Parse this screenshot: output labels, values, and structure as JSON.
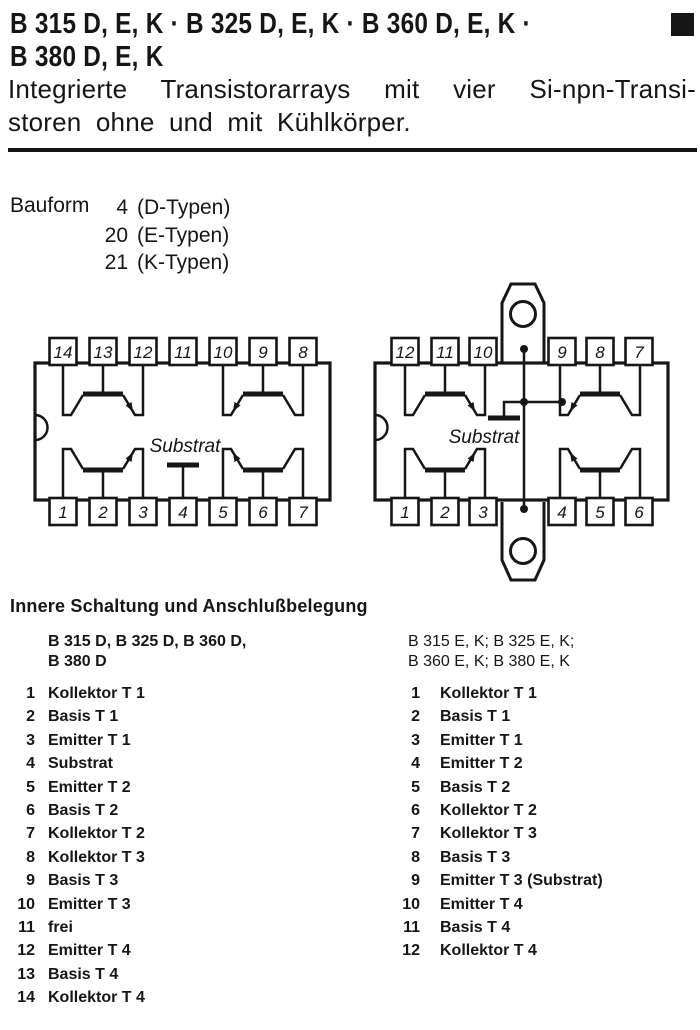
{
  "colors": {
    "ink": "#161616",
    "paper": "#ffffff"
  },
  "page": {
    "title_line1": "B 315 D, E, K · B 325 D, E, K · B 360 D, E, K ·",
    "title_line2": "B 380 D, E, K",
    "subtitle_line1": "Integrierte Transistorarrays mit vier Si-npn-Transi-",
    "subtitle_line2": "storen ohne und mit Kühlkörper."
  },
  "bauform": {
    "label": "Bauform",
    "rows": [
      {
        "num": "4",
        "type": "(D-Typen)"
      },
      {
        "num": "20",
        "type": "(E-Typen)"
      },
      {
        "num": "21",
        "type": "(K-Typen)"
      }
    ]
  },
  "diagrams": {
    "d": {
      "substrate_label": "Substrat",
      "top_pins": [
        "14",
        "13",
        "12",
        "11",
        "10",
        "9",
        "8"
      ],
      "bottom_pins": [
        "1",
        "2",
        "3",
        "4",
        "5",
        "6",
        "7"
      ]
    },
    "ek": {
      "substrate_label": "Substrat",
      "top_pins": [
        "12",
        "11",
        "10",
        "9",
        "8",
        "7"
      ],
      "bottom_pins": [
        "1",
        "2",
        "3",
        "4",
        "5",
        "6"
      ]
    }
  },
  "pinout": {
    "heading": "Innere Schaltung und Anschlußbelegung",
    "left": {
      "header_line1": "B 315 D, B 325 D, B 360 D,",
      "header_line2": "B 380 D",
      "pins": [
        {
          "n": "1",
          "label": "Kollektor T 1"
        },
        {
          "n": "2",
          "label": "Basis T 1"
        },
        {
          "n": "3",
          "label": "Emitter T 1"
        },
        {
          "n": "4",
          "label": "Substrat"
        },
        {
          "n": "5",
          "label": "Emitter T 2"
        },
        {
          "n": "6",
          "label": "Basis T 2"
        },
        {
          "n": "7",
          "label": "Kollektor T 2"
        },
        {
          "n": "8",
          "label": "Kollektor T 3"
        },
        {
          "n": "9",
          "label": "Basis T 3"
        },
        {
          "n": "10",
          "label": "Emitter T 3"
        },
        {
          "n": "11",
          "label": "frei"
        },
        {
          "n": "12",
          "label": "Emitter T 4"
        },
        {
          "n": "13",
          "label": "Basis T 4"
        },
        {
          "n": "14",
          "label": "Kollektor T 4"
        }
      ]
    },
    "right": {
      "header_line1": "B 315 E, K; B 325 E, K;",
      "header_line2": "B 360 E, K; B 380 E, K",
      "pins": [
        {
          "n": "1",
          "label": "Kollektor T 1"
        },
        {
          "n": "2",
          "label": "Basis T 1"
        },
        {
          "n": "3",
          "label": "Emitter T 1"
        },
        {
          "n": "4",
          "label": "Emitter T 2"
        },
        {
          "n": "5",
          "label": "Basis T 2"
        },
        {
          "n": "6",
          "label": "Kollektor T 2"
        },
        {
          "n": "7",
          "label": "Kollektor T 3"
        },
        {
          "n": "8",
          "label": "Basis T 3"
        },
        {
          "n": "9",
          "label": "Emitter T 3 (Substrat)"
        },
        {
          "n": "10",
          "label": "Emitter T 4"
        },
        {
          "n": "11",
          "label": "Basis T 4"
        },
        {
          "n": "12",
          "label": "Kollektor T 4"
        }
      ]
    }
  }
}
